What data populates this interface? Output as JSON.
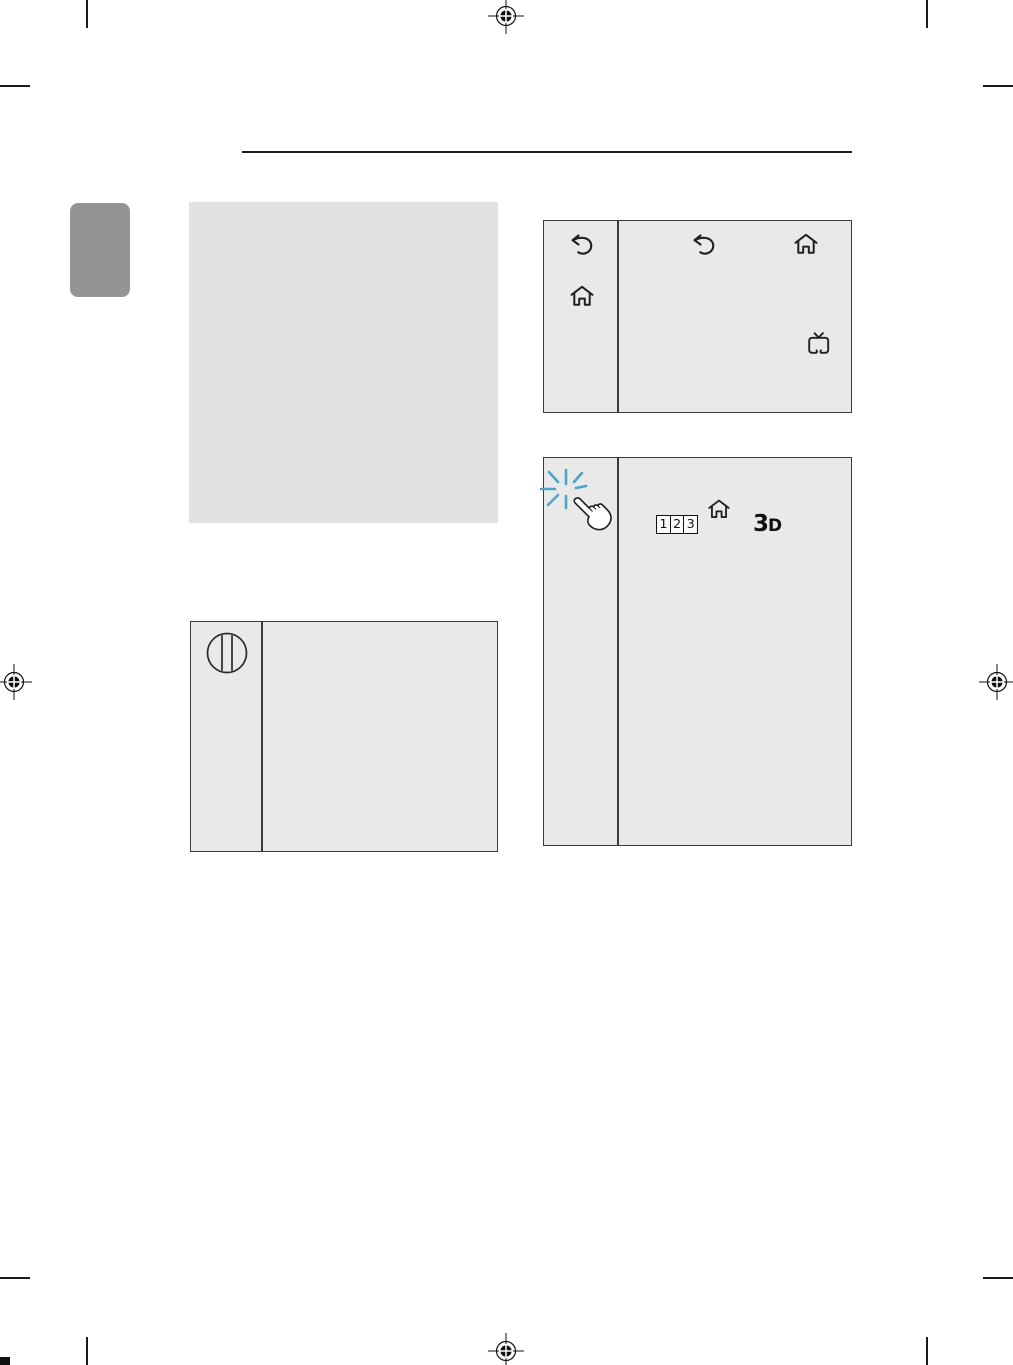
{
  "colors": {
    "page_background": "#ffffff",
    "panel_fill": "#e9e9e9",
    "placeholder_fill": "#e2e2e2",
    "chapter_tab_gray": "#949494",
    "border_dark": "#3a3a3a",
    "sparkle_blue": "#4aa5c8",
    "mark_black": "#1a1a1a"
  },
  "print_marks": {
    "registration_icon": "registration-crosshair-icon",
    "crop_mark_icon": "crop-mark-line",
    "positions": [
      "top-center",
      "left-middle",
      "right-middle",
      "bottom-center"
    ]
  },
  "header": {
    "rule": "horizontal-section-rule"
  },
  "panels": {
    "chapter_tab": {
      "icon": "chapter-tab-marker"
    },
    "placeholder": {
      "icon": "empty-gray-block"
    },
    "remote_basic": {
      "left_column_icons": [
        "back-icon",
        "home-icon"
      ],
      "content_icons": [
        "back-icon",
        "home-icon",
        "tv-icon"
      ]
    },
    "magic_remote": {
      "left_column_icons": [
        "sparkle-icon",
        "pointing-hand-icon"
      ],
      "digit_keys": [
        "1",
        "2",
        "3"
      ],
      "content_icons": [
        "digit-keys",
        "home-icon",
        "3d-logo"
      ],
      "logo_3d": {
        "three": "3",
        "dee": "D"
      }
    },
    "jog_stick": {
      "left_column_icons": [
        "jog-button-icon"
      ]
    }
  }
}
